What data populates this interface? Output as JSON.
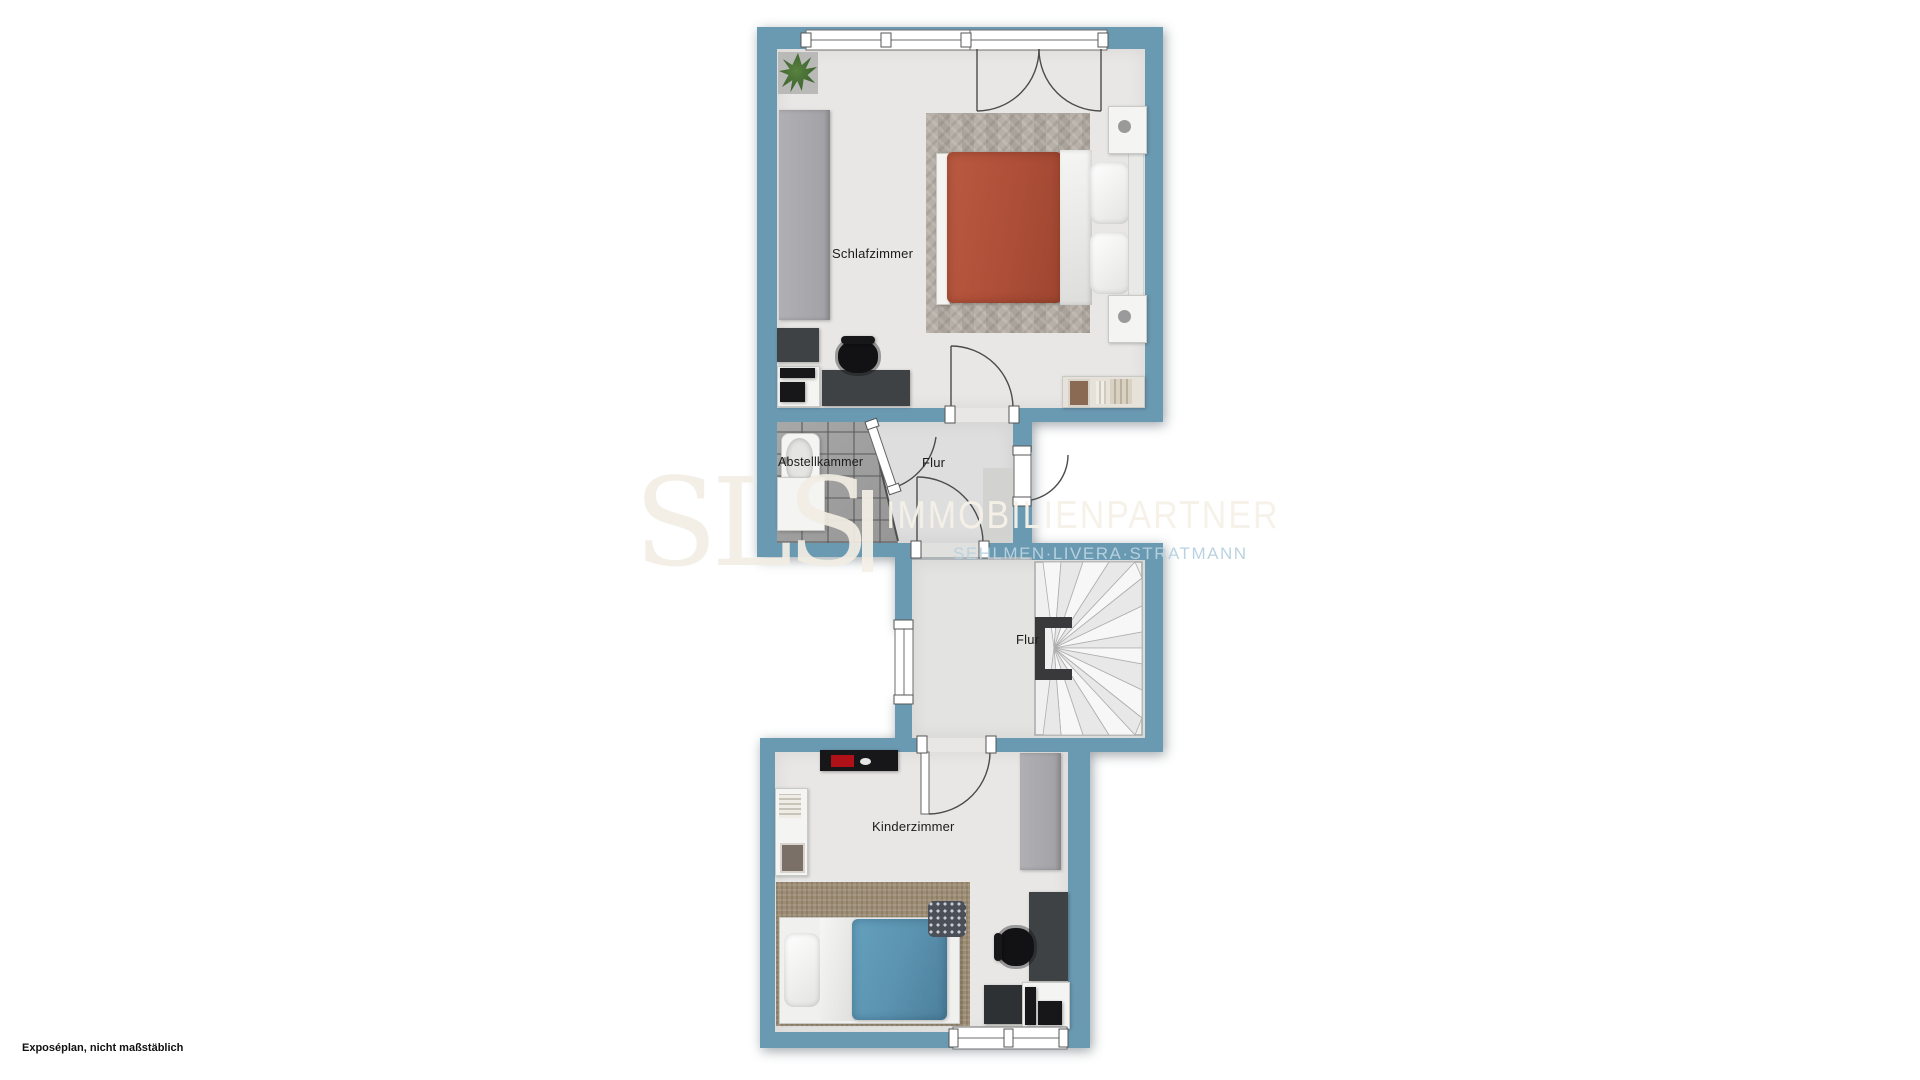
{
  "document": {
    "kind": "floorplan",
    "footer_note": "Exposéplan, nicht maßstäblich"
  },
  "watermark": {
    "logo": "SLS",
    "brand": "IMMOBILIENPARTNER",
    "tagline": "SEHLMEN·LIVERA·STRATMANN"
  },
  "rooms": {
    "schlafzimmer": {
      "label": "Schlafzimmer"
    },
    "abstellkammer": {
      "label": "Abstellkammer"
    },
    "flur_upper": {
      "label": "Flur"
    },
    "flur_lower": {
      "label": "Flur"
    },
    "kinderzimmer": {
      "label": "Kinderzimmer"
    }
  },
  "furniture": {
    "schlafzimmer": [
      "plant",
      "wardrobe",
      "dresser",
      "printer-stand",
      "desk",
      "office-chair",
      "rug",
      "double-bed",
      "nightstand-top",
      "nightstand-bottom",
      "sideboard"
    ],
    "abstellkammer": [
      "sink",
      "cabinet"
    ],
    "flur_lower": [
      "winder-staircase"
    ],
    "kinderzimmer": [
      "tv-board",
      "wall-shelf",
      "wardrobe",
      "rug",
      "single-bed",
      "floor-cushion",
      "desk",
      "office-chair",
      "cabinet",
      "printer-stand"
    ]
  },
  "colors": {
    "wall": "#6a99b2",
    "floor": "#e8e7e5",
    "hall_floor": "#dedede",
    "tile": "#a0a0a0",
    "bedroom_rug": "#b3aca3",
    "kids_rug": "#9d8d75",
    "bed_blanket_orange": "#b0503a",
    "bed_blanket_blue": "#5b93b0",
    "furniture_dark": "#3f4244",
    "furniture_black": "#17171a",
    "watermark_cream": "#f2eee4",
    "watermark_blue": "#b9d2e0"
  }
}
